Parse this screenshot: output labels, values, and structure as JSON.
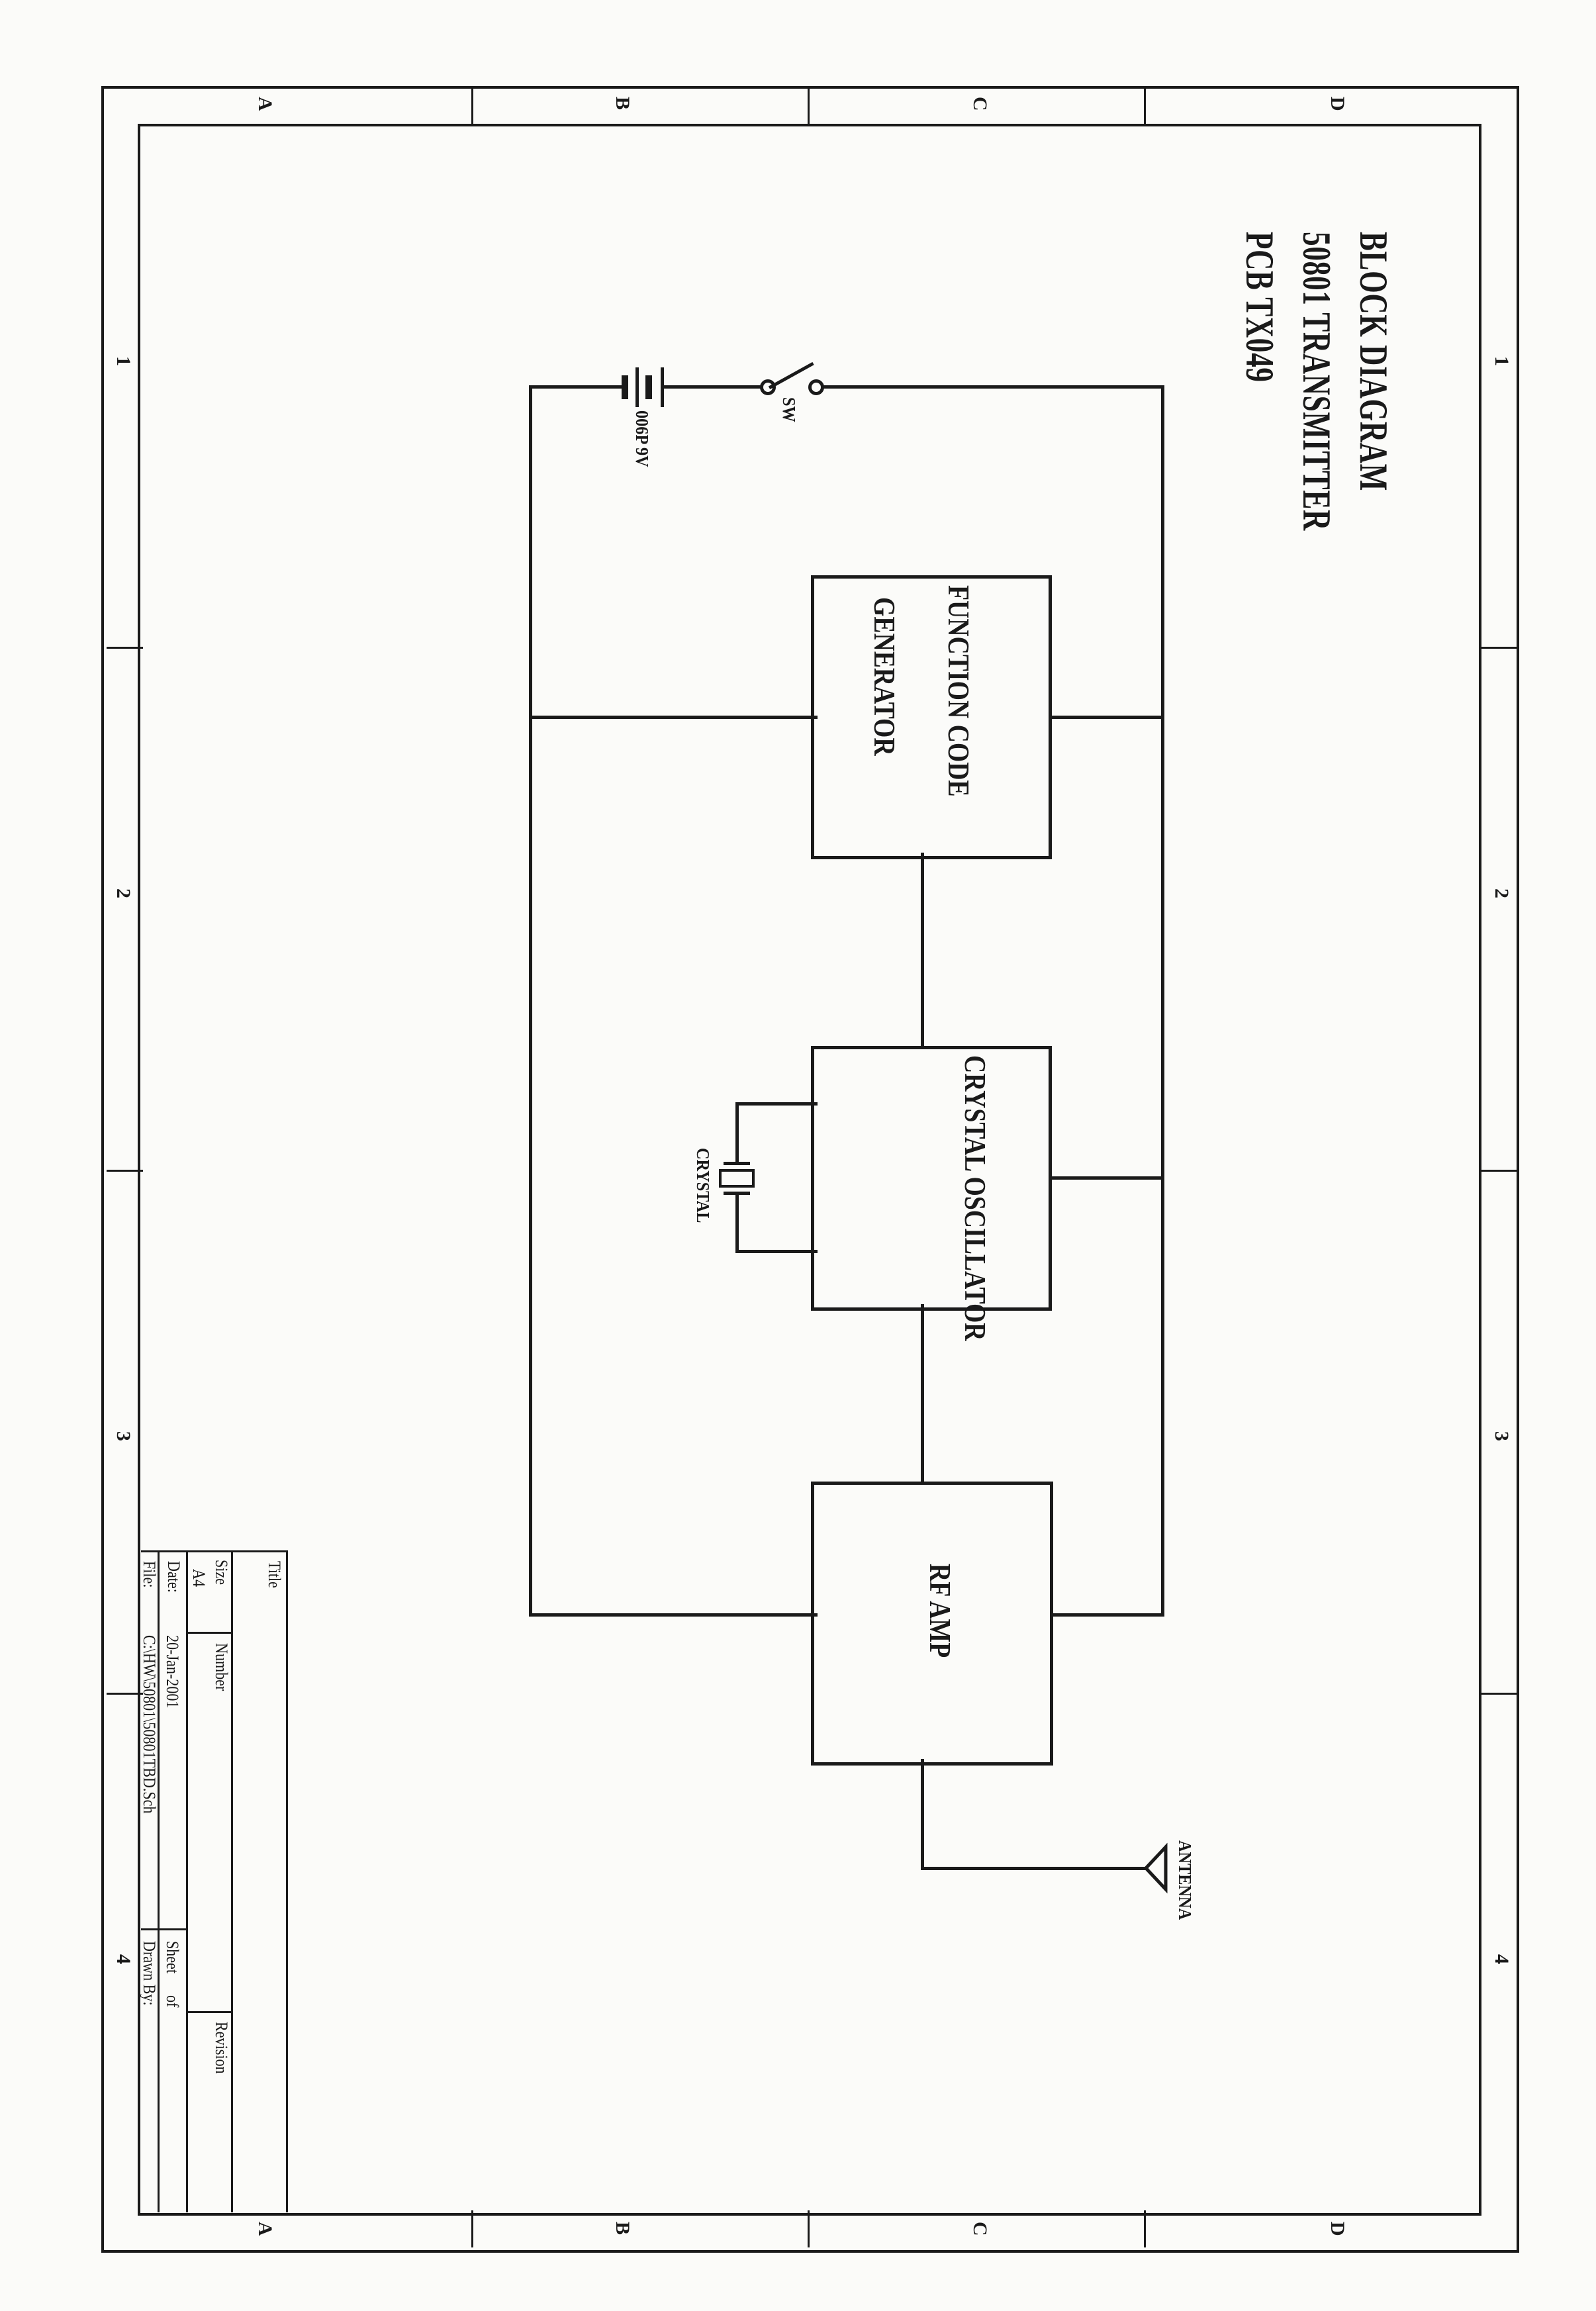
{
  "sheet": {
    "title_lines": [
      "BLOCK DIAGRAM",
      "50801 TRANSMITTER",
      "PCB TX049"
    ]
  },
  "blocks": {
    "function_code_generator": {
      "line1": "FUNCTION CODE",
      "line2": "GENERATOR"
    },
    "crystal_oscillator": {
      "label": "CRYSTAL OSCILLATOR"
    },
    "rf_amp": {
      "label": "RF AMP"
    }
  },
  "components": {
    "battery_label": "006P 9V",
    "switch_label": "SW",
    "crystal_label": "CRYSTAL",
    "antenna_label": "ANTENNA"
  },
  "title_block": {
    "title_label": "Title",
    "size_label": "Size",
    "size_value": "A4",
    "number_label": "Number",
    "revision_label": "Revision",
    "date_label": "Date:",
    "date_value": "20-Jan-2001",
    "sheet_label": "Sheet",
    "of_label": "of",
    "file_label": "File:",
    "file_value": "C:\\HW\\50801\\50801TBD.Sch",
    "drawn_by_label": "Drawn By:"
  },
  "zones": {
    "letters": [
      "D",
      "C",
      "B",
      "A"
    ],
    "numbers": [
      "1",
      "2",
      "3",
      "4"
    ]
  },
  "colors": {
    "ink": "#1a1a1a",
    "paper": "#fbfbf9"
  }
}
